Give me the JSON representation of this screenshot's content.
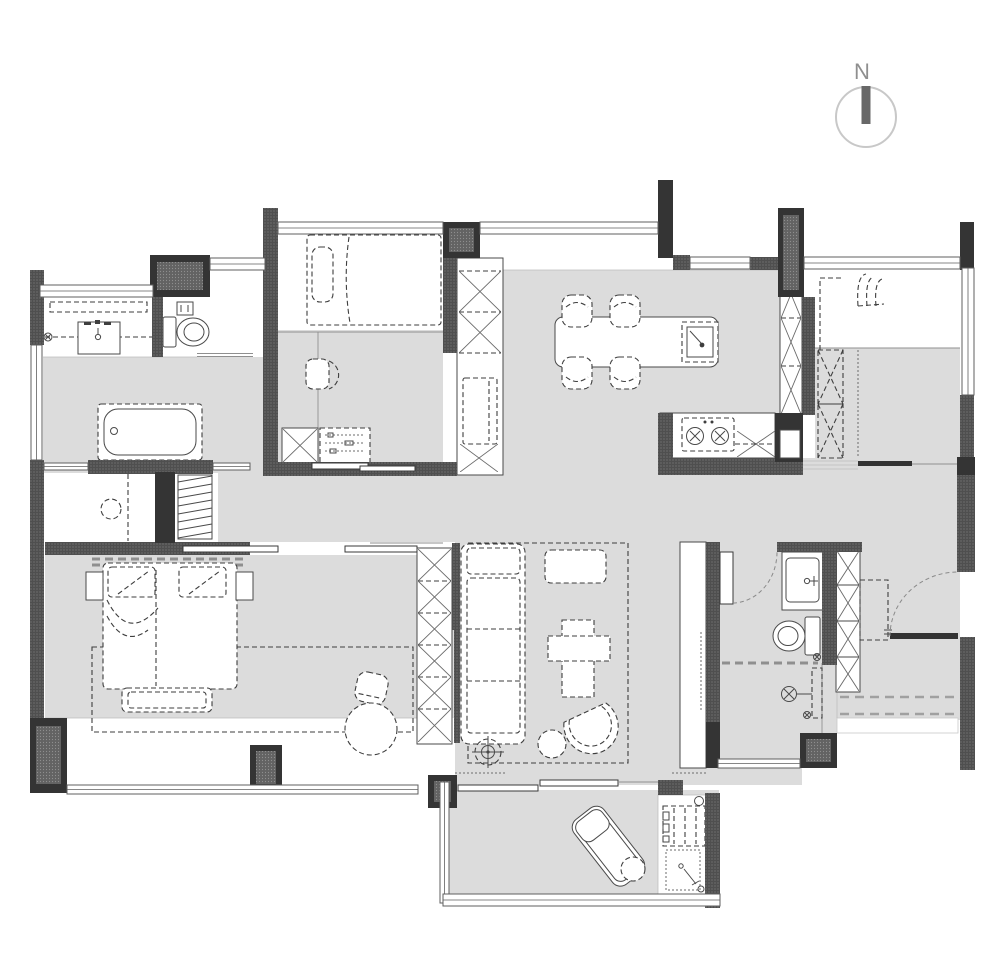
{
  "title": "apartment-floor-plan",
  "compass": {
    "label": "N"
  },
  "palette": {
    "floor": "#dcdcdc",
    "wall-hatch": "#4f4f4f",
    "wall-solid": "#343434",
    "furniture-line": "#3e3e3e",
    "window-line": "#5f5f5f",
    "compass-ring": "#c8c8c8",
    "compass-needle": "#686868",
    "compass-text": "#8f8f8f"
  },
  "plan": {
    "type": "residential-floor-plan",
    "rooms": [
      {
        "name": "bathroom-top-left",
        "furniture": [
          "mirror-cabinet",
          "vanity-sink",
          "faucet",
          "toilet",
          "floor-drain"
        ]
      },
      {
        "name": "bedroom-2",
        "furniture": [
          "single-bed",
          "pillow",
          "desk",
          "desk-chair",
          "x-wardrobe",
          "dresser-with-items",
          "sliding-door"
        ]
      },
      {
        "name": "dining-area",
        "furniture": [
          "dining-table",
          "island-sink",
          "dining-chair-1",
          "dining-chair-2",
          "dining-chair-3",
          "dining-chair-4",
          "tall-storage-column"
        ]
      },
      {
        "name": "kitchen",
        "furniture": [
          "counter",
          "cooktop-two-burners",
          "tall-cabinet-column",
          "duct-block"
        ]
      },
      {
        "name": "bedroom-3-top-right",
        "furniture": [
          "small-armchair",
          "closet-outline",
          "x-wardrobe",
          "sliding-door"
        ]
      },
      {
        "name": "dressing-area",
        "furniture": [
          "bathtub",
          "round-stool",
          "hanging-rack"
        ]
      },
      {
        "name": "master-bedroom",
        "furniture": [
          "double-bed",
          "pillow-left",
          "pillow-right",
          "headboard",
          "nightstand-left",
          "nightstand-right",
          "foot-bench",
          "rug",
          "armchair",
          "round-pouf",
          "x-wardrobe",
          "sliding-door",
          "bay-window"
        ]
      },
      {
        "name": "living-room",
        "furniture": [
          "sofa",
          "coffee-table-cross",
          "tv-bench",
          "lounge-chair",
          "round-ottoman",
          "floor-lamp",
          "rug",
          "sliding-partition"
        ]
      },
      {
        "name": "bathroom-right",
        "furniture": [
          "vanity-sink",
          "toilet",
          "shower-head",
          "shower-screen-dashed",
          "floor-drain",
          "swing-door"
        ]
      },
      {
        "name": "entry",
        "furniture": [
          "shoe-cabinet-x",
          "door-mat",
          "entry-door-swing",
          "entry-step"
        ]
      },
      {
        "name": "balcony",
        "furniture": [
          "sun-lounger",
          "round-side-table",
          "washing-machine",
          "laundry-sink",
          "floor-drain"
        ]
      }
    ]
  }
}
